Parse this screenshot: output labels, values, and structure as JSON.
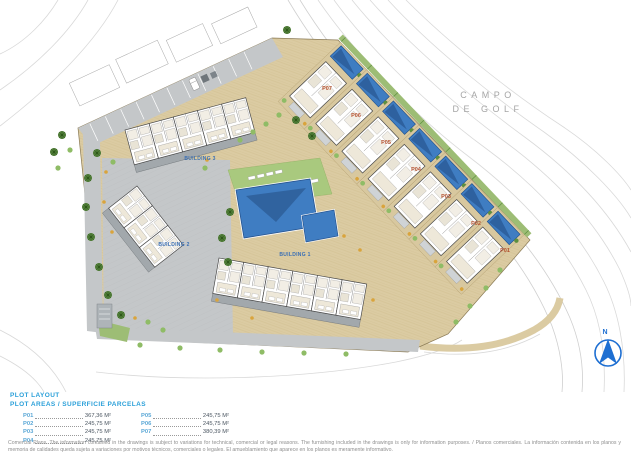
{
  "plan": {
    "golf_course_label": {
      "line1": "CAMPO",
      "line2": "DE GOLF"
    },
    "compass": {
      "north_label": "N",
      "color": "#1e6fd2"
    },
    "buildings": [
      {
        "label": "BUILDING 3"
      },
      {
        "label": "BUILDING 2"
      },
      {
        "label": "BUILDING 1"
      }
    ],
    "plots": [
      {
        "label": "P01"
      },
      {
        "label": "P02"
      },
      {
        "label": "P03"
      },
      {
        "label": "P04"
      },
      {
        "label": "P05"
      },
      {
        "label": "P06"
      },
      {
        "label": "P07"
      }
    ],
    "colors": {
      "paving_tan": "#dbcba2",
      "road_gray": "#c4c7c9",
      "pool_blue": "#3f7dc2",
      "lawn_green": "#a9c97e",
      "building_label_blue": "#3a6fb5",
      "plot_label_red": "#b5512f",
      "contour_gray": "#d9d9d9"
    }
  },
  "legend": {
    "title": "PLOT LAYOUT",
    "subtitle": "PLOT AREAS / SUPERFICIE PARCELAS",
    "items": [
      {
        "code": "P01",
        "area": "367,36 M²"
      },
      {
        "code": "P02",
        "area": "245,75 M²"
      },
      {
        "code": "P03",
        "area": "245,75 M²"
      },
      {
        "code": "P04",
        "area": "245,75 M²"
      },
      {
        "code": "P05",
        "area": "245,75 M²"
      },
      {
        "code": "P06",
        "area": "245,75 M²"
      },
      {
        "code": "P07",
        "area": "380,39 M²"
      }
    ]
  },
  "disclaimer": "Comercial Plans. The information contained in the drawings is subject to variations for technical, comercial or legal reasons. The furnishing included in the drawings is only for information purposes. / Planos comerciales. La información contenida en los planos y memoria de calidades queda sujeta a variaciones por motivos técnicos, comerciales o legales. El amueblamiento que aparece en los planos es meramente informativo."
}
